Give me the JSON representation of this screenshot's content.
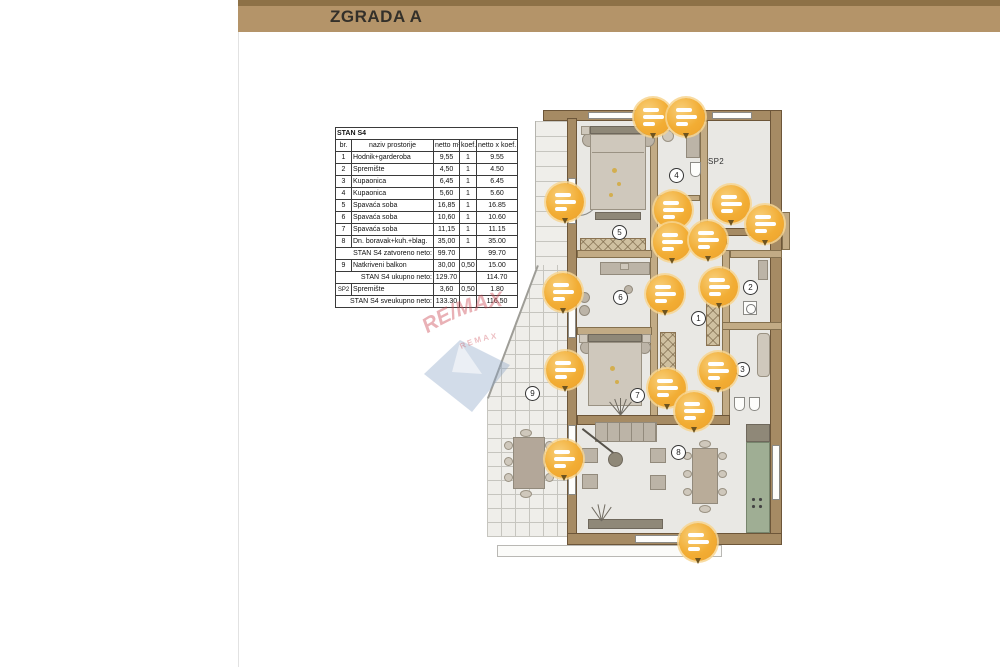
{
  "header": {
    "title": "ZGRADA A"
  },
  "table": {
    "title": "STAN S4",
    "columns": {
      "br": "br.",
      "name": "naziv prostorije",
      "netto": "netto m²",
      "koef": "koef.",
      "total": "netto x koef. m²"
    },
    "rows": [
      {
        "br": "1",
        "name": "Hodnik+garderoba",
        "netto": "9,55",
        "koef": "1",
        "total": "9.55"
      },
      {
        "br": "2",
        "name": "Spremište",
        "netto": "4,50",
        "koef": "1",
        "total": "4.50"
      },
      {
        "br": "3",
        "name": "Kupaonica",
        "netto": "6,45",
        "koef": "1",
        "total": "6.45"
      },
      {
        "br": "4",
        "name": "Kupaonica",
        "netto": "5,60",
        "koef": "1",
        "total": "5.60"
      },
      {
        "br": "5",
        "name": "Spavaća soba",
        "netto": "16,85",
        "koef": "1",
        "total": "16.85"
      },
      {
        "br": "6",
        "name": "Spavaća soba",
        "netto": "10,60",
        "koef": "1",
        "total": "10.60"
      },
      {
        "br": "7",
        "name": "Spavaća soba",
        "netto": "11,15",
        "koef": "1",
        "total": "11.15"
      },
      {
        "br": "8",
        "name": "Dn. boravak+kuh.+blag.",
        "netto": "35,00",
        "koef": "1",
        "total": "35.00"
      }
    ],
    "subtotal_closed": {
      "label": "STAN S4 zatvoreno neto:",
      "netto": "99.70",
      "total": "99.70"
    },
    "row_balcony": {
      "br": "9",
      "name": "Natkriveni balkon",
      "netto": "30,00",
      "koef": "0,50",
      "total": "15.00"
    },
    "subtotal_total": {
      "label": "STAN S4 ukupno neto:",
      "netto": "129.70",
      "total": "114.70"
    },
    "row_storage": {
      "br": "SP2",
      "name": "Spremište",
      "netto": "3,60",
      "koef": "0,50",
      "total": "1.80"
    },
    "grand_total": {
      "label": "STAN S4 sveukupno neto:",
      "netto": "133.30",
      "total": "116.50"
    }
  },
  "floorplan": {
    "room_numbers": [
      "1",
      "2",
      "3",
      "4",
      "5",
      "6",
      "7",
      "8",
      "9"
    ],
    "labels": {
      "storage": "SP2",
      "unit": "S4"
    },
    "marker_icon": "photo-pin-icon",
    "marker_count": 17
  },
  "watermark": {
    "brand": "RE/MAX",
    "sub": "REMAX"
  },
  "colors": {
    "header_bar": "#b49469",
    "header_bar_top": "#8d7147",
    "title_text": "#33302a",
    "wall": "#a68b64",
    "wall_dark": "#6d5639",
    "floor": "#e9e8e4",
    "kitchen_counter": "#9fae94",
    "furniture": "#bcb4a7",
    "marker_orange": "#f0a42f",
    "watermark_red": "#cf5560",
    "watermark_blue": "#8ba6c4"
  }
}
